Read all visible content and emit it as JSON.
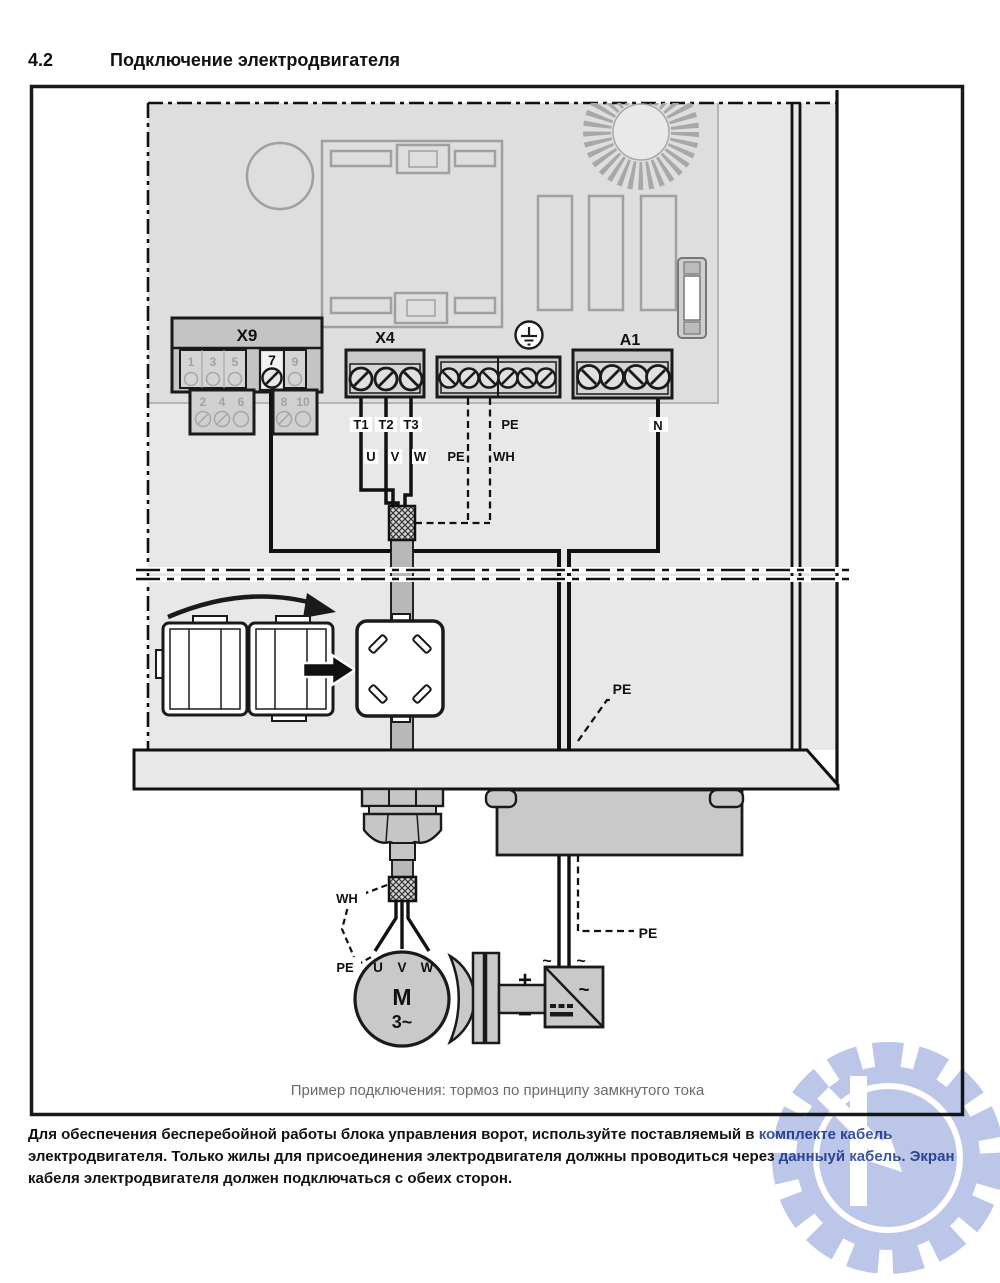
{
  "header": {
    "section": "4.2",
    "title": "Подключение электродвигателя"
  },
  "terminals": {
    "x9": {
      "label": "X9",
      "selected": "7",
      "row_top": [
        "1",
        "3",
        "5"
      ],
      "row_top_right": "9",
      "row_bottom_left": [
        "2",
        "4",
        "6"
      ],
      "row_bottom_right": [
        "8",
        "10"
      ]
    },
    "x4": {
      "label": "X4"
    },
    "a1": {
      "label": "A1"
    }
  },
  "labels": {
    "t1": "T1",
    "t2": "T2",
    "t3": "T3",
    "u": "U",
    "v": "V",
    "w": "W",
    "pe": "PE",
    "wh": "WH",
    "n": "N",
    "plus": "+",
    "minus": "−",
    "ac": "~"
  },
  "motor": {
    "u": "U",
    "v": "V",
    "w": "W",
    "m": "M",
    "phase": "3~"
  },
  "caption": "Пример подключения: тормоз по принципу замкнутого тока",
  "note": {
    "line1_black": "Для обеспечения бесперебойной работы блока управления ворот, используйте поставляемый в ",
    "line1_blue": "комплекте кабель",
    "line2_black": "электродвигателя. Только жилы для присоединения электродвигателя должны проводиться через ",
    "line2_blue": "данныуй кабель. Экран",
    "line3_black": "кабеля электродвигателя должен подключаться с обеих сторон."
  },
  "watermark": {
    "letter": "K"
  },
  "colors": {
    "note_highlight": "#3b55a5",
    "watermark_blue": "#b7c1e6",
    "enclosure_gray": "#e8e8e8",
    "pcb_gray": "#dedede",
    "part_gray": "#c9c9c9"
  }
}
